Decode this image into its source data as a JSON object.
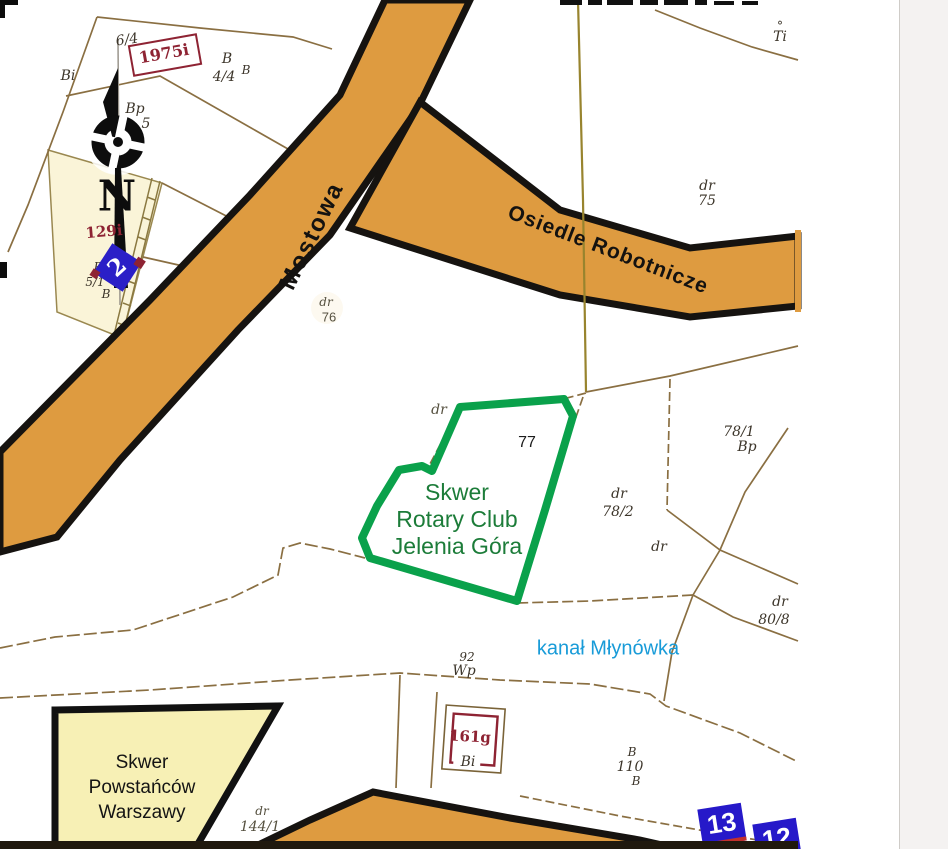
{
  "canvas": {
    "width": 948,
    "height": 849,
    "background": "#ffffff",
    "side_strip_color": "#f4f2f1"
  },
  "colors": {
    "road_fill": "#DE9B40",
    "road_outline": "#161310",
    "boundary_line": "#8a6f42",
    "green_outline": "#0aa14b",
    "green_text": "#1c7c39",
    "canal_text": "#189bd8",
    "maroon_parcel_number": "#8e2333",
    "yellow_area_fill": "#f7f0b5",
    "cream_parcel_fill": "#faf4d8",
    "marker_blue": "#2b1fc7",
    "bottom_band": "#20190e"
  },
  "streets": {
    "mostowa": "Mostowa",
    "osiedle": "Osiedle Robotnicze"
  },
  "green_area": {
    "line1": "Skwer",
    "line2": "Rotary Club",
    "line3": "Jelenia Góra",
    "parcel": "77"
  },
  "yellow_area": {
    "line1": "Skwer",
    "line2": "Powstańców",
    "line3": "Warszawy"
  },
  "canal": {
    "label": "kanał Młynówka"
  },
  "compass": {
    "north": "N"
  },
  "markers": {
    "m2": "2",
    "m13": "13",
    "m12": "12"
  },
  "labels": {
    "p6_4": "6/4",
    "bi_tl": "Bi",
    "p1975": "1975i",
    "b_a": "B",
    "p4_4": "4/4",
    "b_b": "B",
    "bp_tl": "Bp",
    "p5": "5",
    "p129": "129i",
    "b_c": "B",
    "p5_1": "5/1",
    "b_d": "B",
    "dr76_dr": "dr",
    "dr76_num": "76",
    "dr75_dr": "dr",
    "dr75_num": "75",
    "ti_deg": "°",
    "ti": "Ti",
    "dr_parcel77": "dr",
    "p77": "77",
    "p78_1": "78/1",
    "bp_r": "Bp",
    "dr78_dr": "dr",
    "p78_2": "78/2",
    "dr_mid": "dr",
    "dr80_dr": "dr",
    "p80_8": "80/8",
    "p92": "92",
    "wp": "Wp",
    "p161g": "161g",
    "bi_b": "Bi",
    "b_e": "B",
    "p110": "110",
    "b_f": "B",
    "dr144_dr": "dr",
    "p144_1": "144/1"
  }
}
